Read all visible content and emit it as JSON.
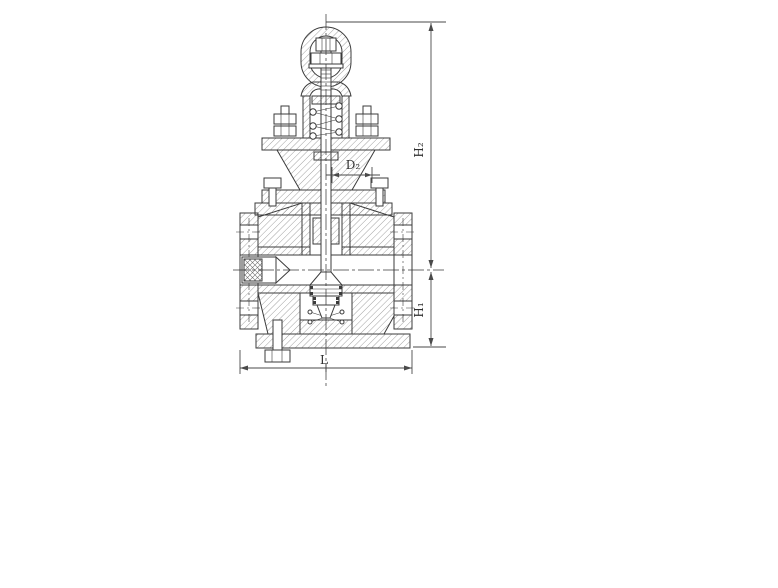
{
  "drawing": {
    "subject": "pressure-reducing-valve-sectional-drawing",
    "colors": {
      "bg": "#ffffff",
      "line": "#3b3b3b",
      "hatch": "#6f6f6f",
      "dim": "#4a4a4a",
      "text": "#2f2f2f"
    },
    "dimensions": {
      "h2": {
        "label": "H₂"
      },
      "h1": {
        "label": "H₁"
      },
      "l": {
        "label": "L"
      },
      "d2": {
        "label": "D₂"
      }
    }
  }
}
